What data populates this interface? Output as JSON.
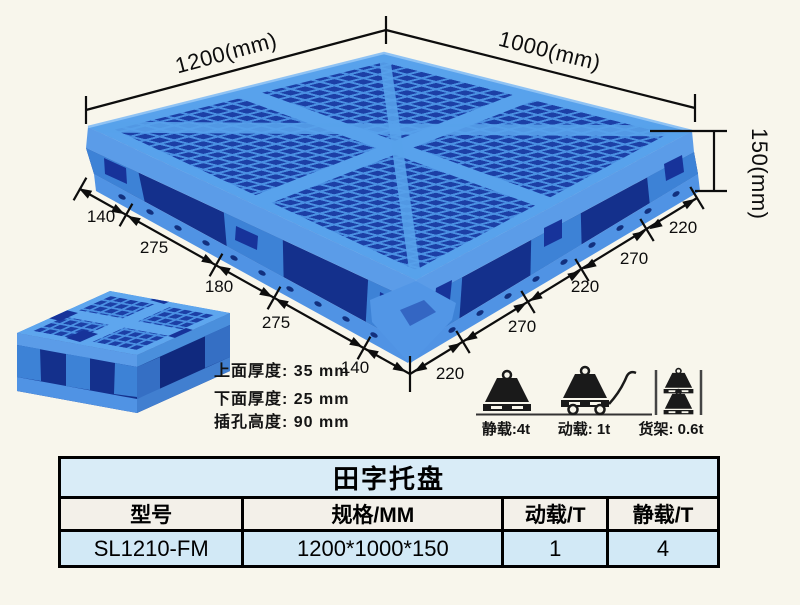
{
  "product_view": {
    "dim_width": "1200(mm)",
    "dim_depth": "1000(mm)",
    "dim_height": "150(mm)",
    "bottom_left_dims": [
      "140",
      "275",
      "180",
      "275",
      "140"
    ],
    "bottom_right_dims": [
      "220",
      "270",
      "220",
      "270",
      "220"
    ],
    "thickness_notes": [
      "上面厚度: 35 mm",
      "下面厚度: 25 mm",
      "插孔高度: 90 mm"
    ]
  },
  "load_ratings": [
    {
      "icon": "static-load-icon",
      "label": "静载:4t"
    },
    {
      "icon": "dynamic-load-icon",
      "label": "动载: 1t"
    },
    {
      "icon": "rack-load-icon",
      "label": "货架: 0.6t"
    }
  ],
  "spec_table": {
    "title": "田字托盘",
    "headers": [
      "型号",
      "规格/MM",
      "动载/T",
      "静载/T"
    ],
    "rows": [
      [
        "SL1210-FM",
        "1200*1000*150",
        "1",
        "4"
      ]
    ]
  },
  "colors": {
    "pallet_light": "#5b9ce8",
    "pallet_medium": "#3d82d6",
    "pallet_dark": "#1c3fa6",
    "table_title_bg": "#d9ecf7",
    "table_row_bg": "#d2e9f6",
    "table_header_bg": "#f3f0e9",
    "dimension_line": "#0d0d0d",
    "background": "#f8f6ec"
  }
}
